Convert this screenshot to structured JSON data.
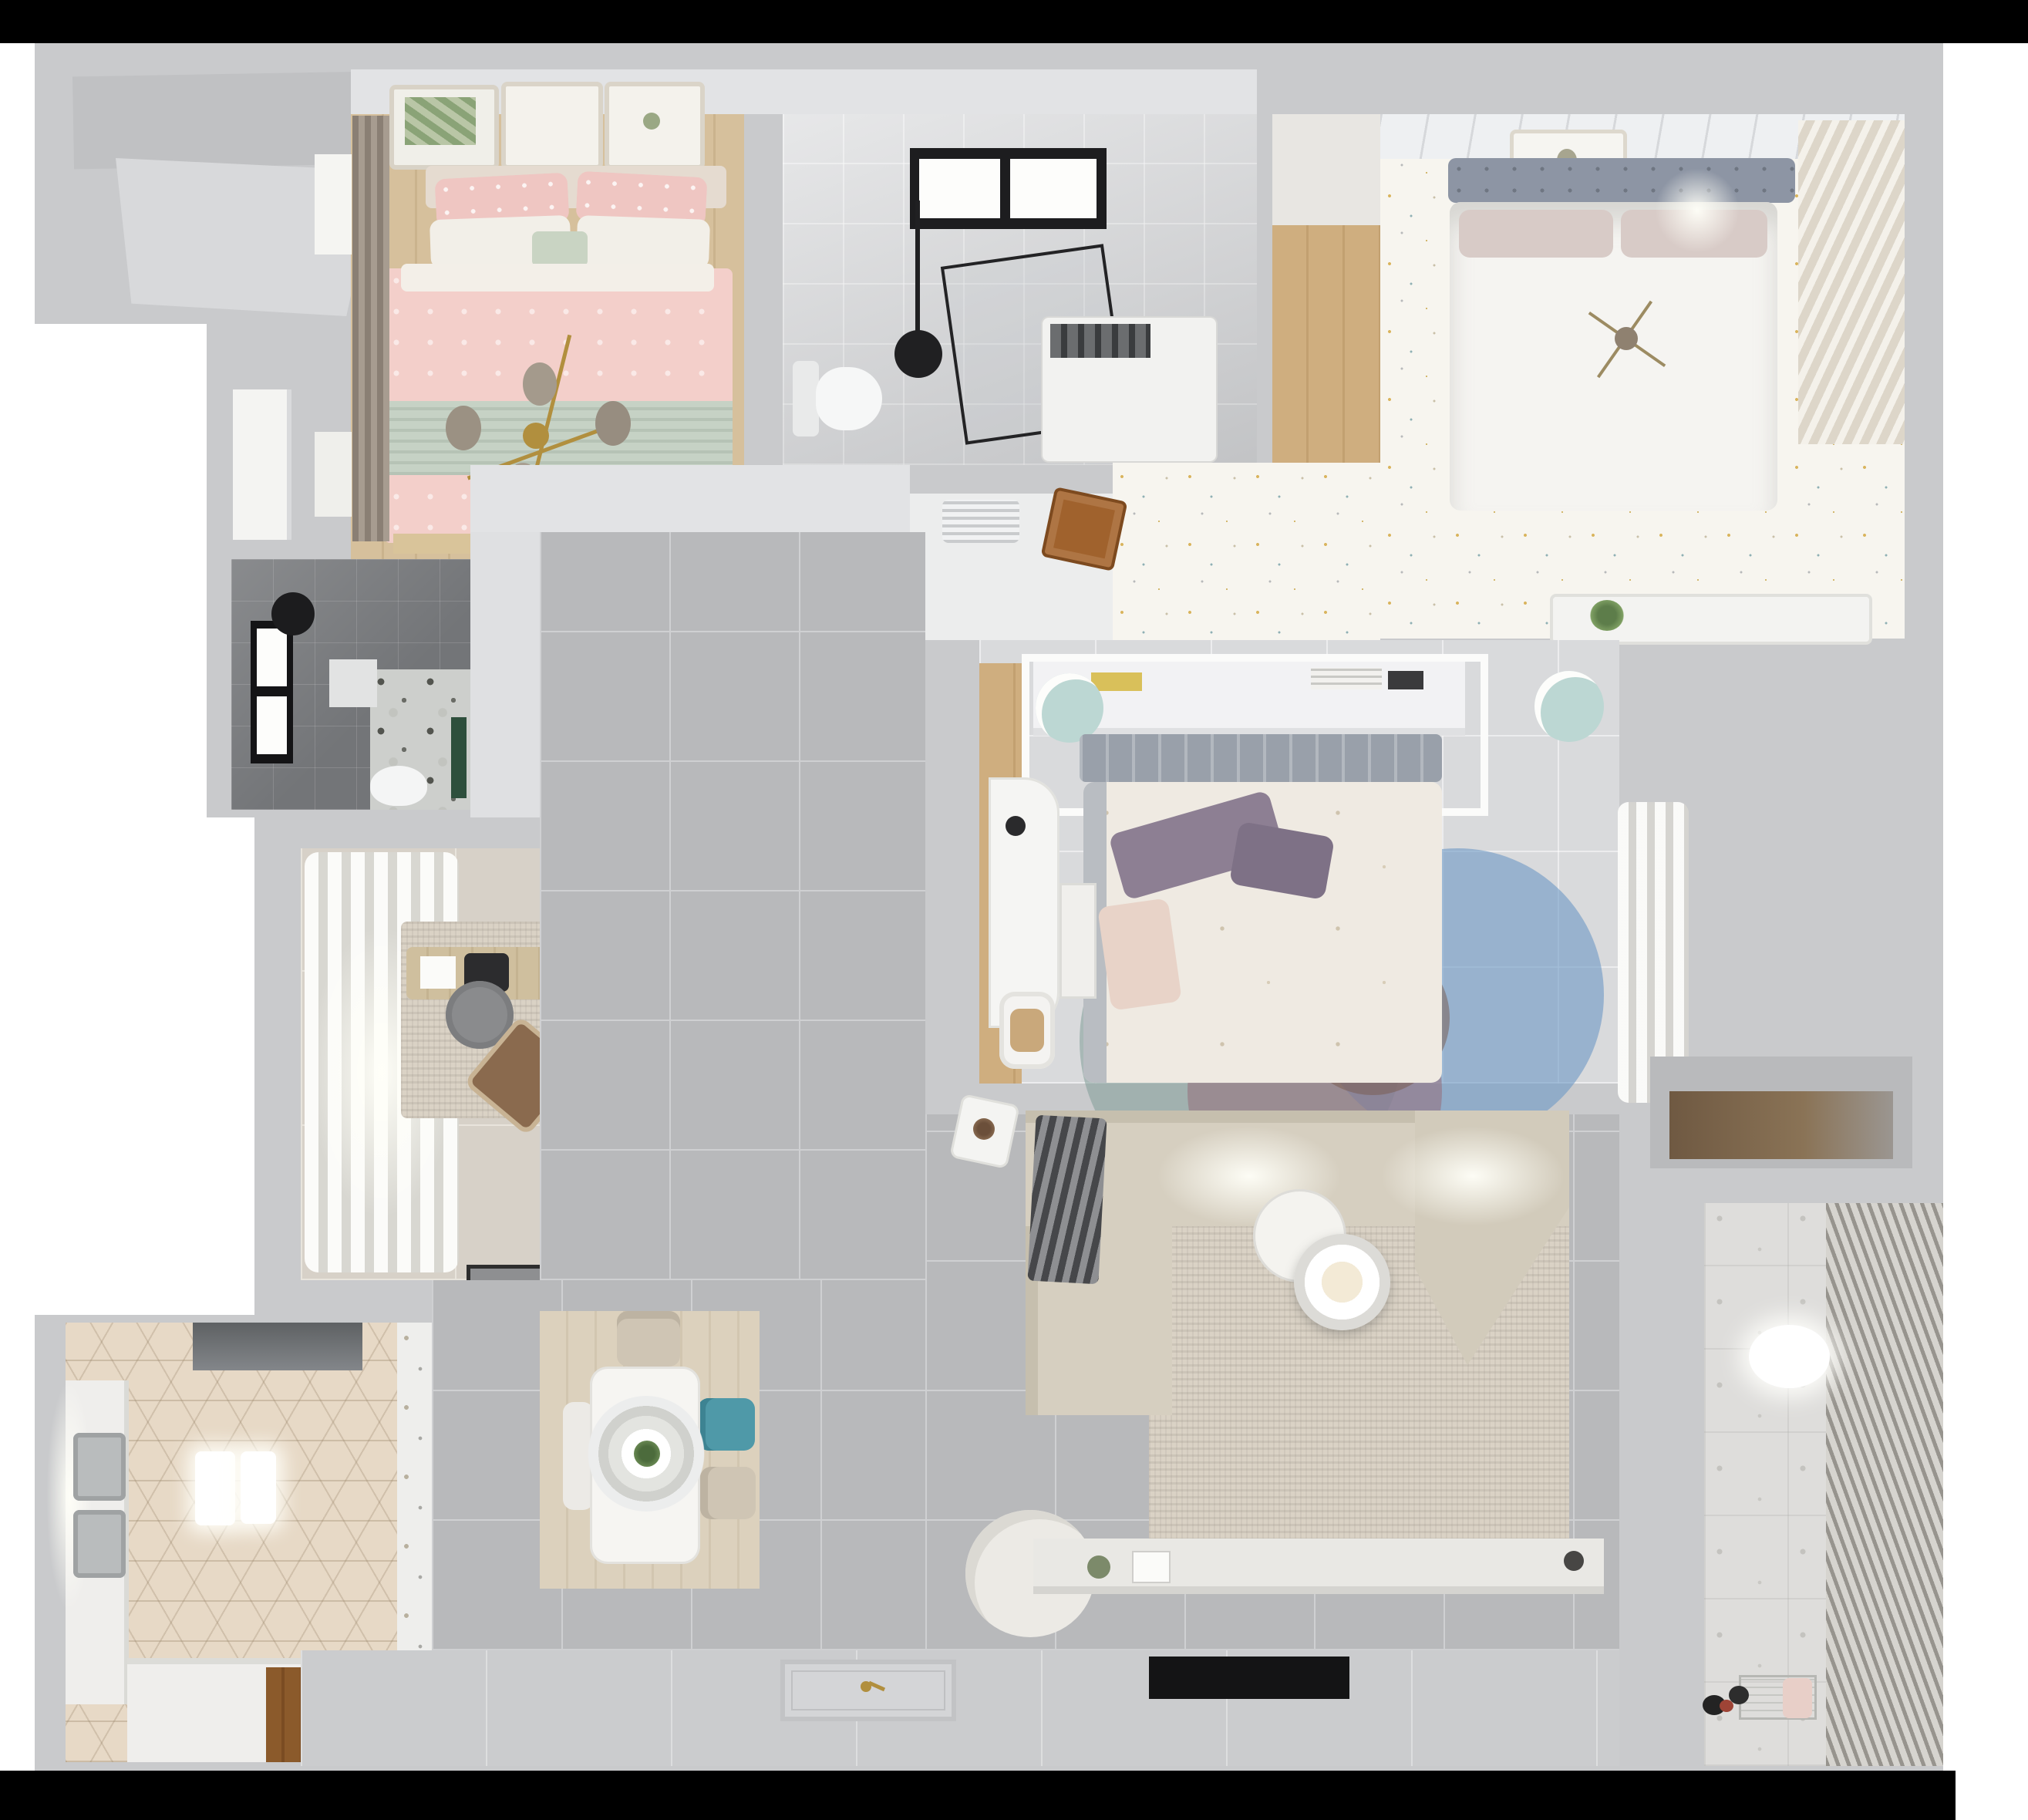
{
  "scene": {
    "title": "Apartment 3D floor plan render",
    "description": "Top-down dollhouse render of a three-bedroom apartment with two bathrooms, study, kitchen, dining area, living room and laundry balcony. Black letterbox bars at top and bottom of the frame.",
    "view": "top-down"
  },
  "palette": {
    "letterbox": "#000000",
    "background": "#ffffff",
    "wall": "#c9cacc",
    "wall_face": "#e2e3e5",
    "hall_tile": "#b8b9bb",
    "wood_floor": "#d6c09c",
    "pink_bedding": "#f3cfca",
    "sage_bedding": "#c6d2c5",
    "gold_chandelier": "#b18f3e",
    "gray_headboard": "#8d95a4",
    "speckle_floor": "#f7f5ef",
    "dark_bath_tile": "#737578",
    "teal_chair": "#4f99a8",
    "mint_stool": "#bcd7d3",
    "purple_pillow": "#8d7f93",
    "open_door_wood": "#a0622d",
    "sofa": "#d6cfc0",
    "rug_blue": "#6c98c4",
    "rug_mauve": "#966e7a",
    "rug_teal": "#809c98",
    "hex_kitchen_tile": "#e7d9c6",
    "balcony_tile": "#dedddb"
  },
  "rooms": {
    "bedroom1": {
      "name": "Bedroom 1 — pink double bed",
      "items": [
        "three wall-art frames",
        "beige headboard",
        "pink patterned pillows",
        "white pillows",
        "sage throw band",
        "gold branch chandelier with glass globes",
        "taupe curtain",
        "wood plank floor"
      ]
    },
    "bathroom1": {
      "name": "Bathroom 1 — marble shower room",
      "items": [
        "black framed window",
        "ceiling shower head",
        "glass shower enclosure",
        "washing machine",
        "toilet"
      ]
    },
    "entry_closet": {
      "name": "Entry closet with wood floor",
      "items": [
        "wood plank floor"
      ]
    },
    "bedroom2": {
      "name": "Bedroom 2 — white bed on speckled floor",
      "items": [
        "gray tufted headboard",
        "white duvet",
        "blush pillows",
        "wall art",
        "louvered wardrobe",
        "gold sprig decor",
        "AC vent",
        "open wooden door",
        "shelf with plant"
      ]
    },
    "bathroom2": {
      "name": "Bathroom 2 — dark tiled shower",
      "items": [
        "window",
        "ceiling shower head",
        "shower tray",
        "toilet",
        "green accent",
        "floral tile zone"
      ]
    },
    "study": {
      "name": "Study",
      "items": [
        "billowing white curtains",
        "abstract rug",
        "wooden desk",
        "laptop",
        "black art frame",
        "gray swivel chair",
        "brown lounge chair",
        "doormat"
      ]
    },
    "bedroom3": {
      "name": "Bedroom 3 — center bedroom",
      "items": [
        "headboard shelf with books",
        "gray headboard",
        "floral duvet",
        "purple pillows",
        "two mint stools",
        "white desk and stool",
        "overlapping-circles rug",
        "sheer curtain",
        "wood closet strip"
      ]
    },
    "kitchen": {
      "name": "Kitchen",
      "items": [
        "hexagon tile floor",
        "range hood",
        "double stainless sink",
        "two pendant lights",
        "white counters",
        "wood threshold",
        "patterned glass partition"
      ]
    },
    "dining": {
      "name": "Dining area",
      "items": [
        "white rectangular table",
        "ring pendant lamp with plant",
        "beige chair",
        "teal chair",
        "beige chair",
        "white chair",
        "light wood floor panel"
      ]
    },
    "living": {
      "name": "Living room",
      "items": [
        "corner sectional sofa",
        "dark striped throw",
        "beige area rug",
        "round coffee table set",
        "white armchair",
        "white side table with plant",
        "TV console with decor",
        "wall TV panel"
      ]
    },
    "hall": {
      "name": "Hallway",
      "items": [
        "large gray floor tiles",
        "entry doormat with keys"
      ]
    },
    "balcony": {
      "name": "Laundry balcony",
      "items": [
        "patterned tile floor",
        "louvered blinds",
        "ceiling light",
        "toys",
        "drying rack",
        "wood storage nook"
      ]
    }
  }
}
